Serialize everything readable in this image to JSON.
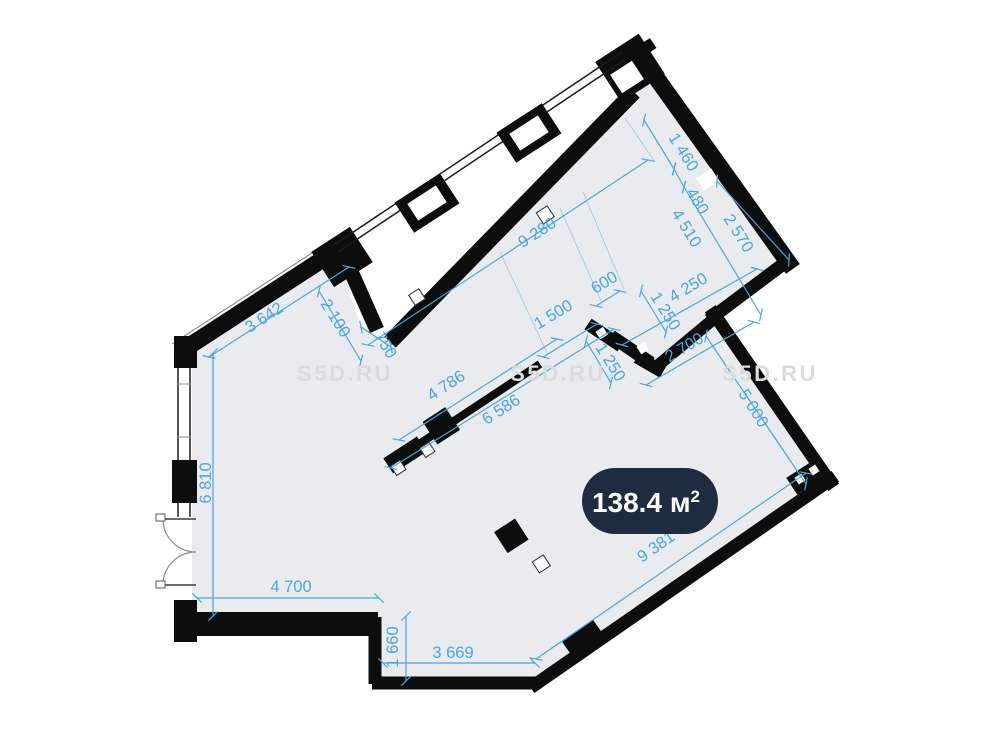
{
  "plan": {
    "watermark": "S5D.RU",
    "badge": {
      "value": "138.4",
      "unit": " м",
      "sup": "2"
    },
    "colors": {
      "floor": "#e9ebee",
      "wall": "#0d0d0d",
      "dim": "#4aa5e2",
      "badge_bg": "#1e2b40",
      "badge_text": "#ffffff",
      "watermark": "#d9dbdd"
    },
    "dims": {
      "d9280": "9 280",
      "d1460": "1 460",
      "d480": "480",
      "d4510": "4 510",
      "d2570": "2 570",
      "d600": "600",
      "d4250": "4 250",
      "d1250a": "1 250",
      "d1500": "1 500",
      "d1250b": "1 250",
      "d2700": "2 700",
      "d750": "750",
      "d3642": "3 642",
      "d2100": "2 100",
      "d4786": "4 786",
      "d6586": "6 586",
      "d5000": "5 000",
      "d6810": "6 810",
      "d4700": "4 700",
      "d1660": "1 660",
      "d3669": "3 669",
      "d9381": "9 381"
    }
  }
}
